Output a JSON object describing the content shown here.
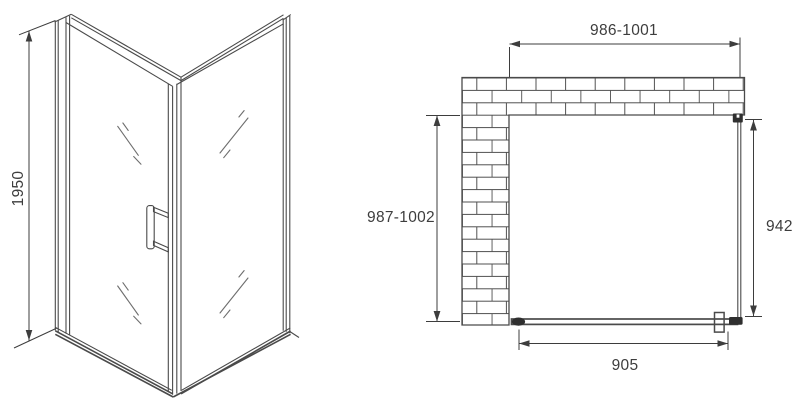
{
  "colors": {
    "background": "#ffffff",
    "line": "#4a4a4a",
    "text": "#3d3d3d",
    "fixture": "#2f2f2f",
    "glass_mark": "#6e6e6e"
  },
  "front_view": {
    "height_label": "1950"
  },
  "plan_view": {
    "top_width_label": "986-1001",
    "left_depth_label": "987-1002",
    "right_panel_label": "942",
    "bottom_door_label": "905"
  }
}
